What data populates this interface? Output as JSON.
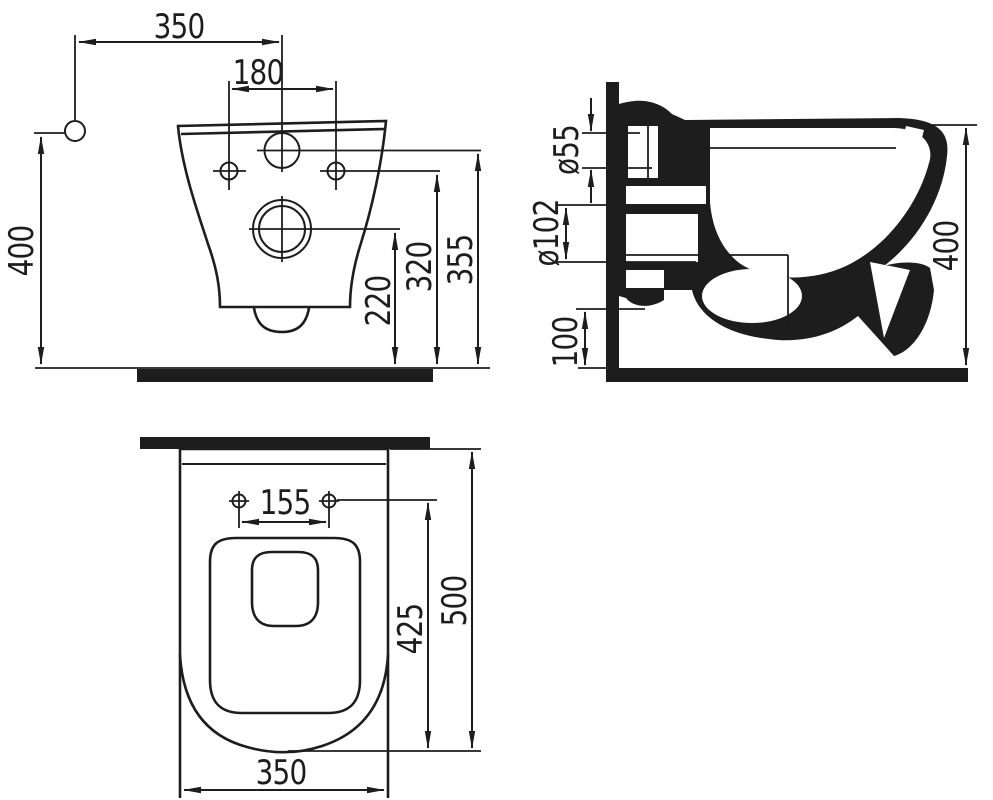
{
  "drawing": {
    "title": "wall-hung-toilet-technical-drawing",
    "colors": {
      "line": "#1d1d1d",
      "background": "#ffffff"
    },
    "front_view": {
      "name": "front view",
      "dims": {
        "overall_width": "350",
        "bolt_spacing": "180",
        "mounting_height": "400",
        "drain_axis_height": "220",
        "bolt_axis_height": "320",
        "rim_top_height": "355"
      }
    },
    "side_view": {
      "name": "side section view",
      "dims": {
        "inlet_diameter": "ø55",
        "outlet_diameter": "ø102",
        "outlet_bottom_height": "100",
        "rim_height": "400"
      }
    },
    "plan_view": {
      "name": "plan view",
      "dims": {
        "bolt_spacing": "155",
        "bowl_depth": "425",
        "overall_depth": "500",
        "overall_width": "350"
      }
    }
  }
}
